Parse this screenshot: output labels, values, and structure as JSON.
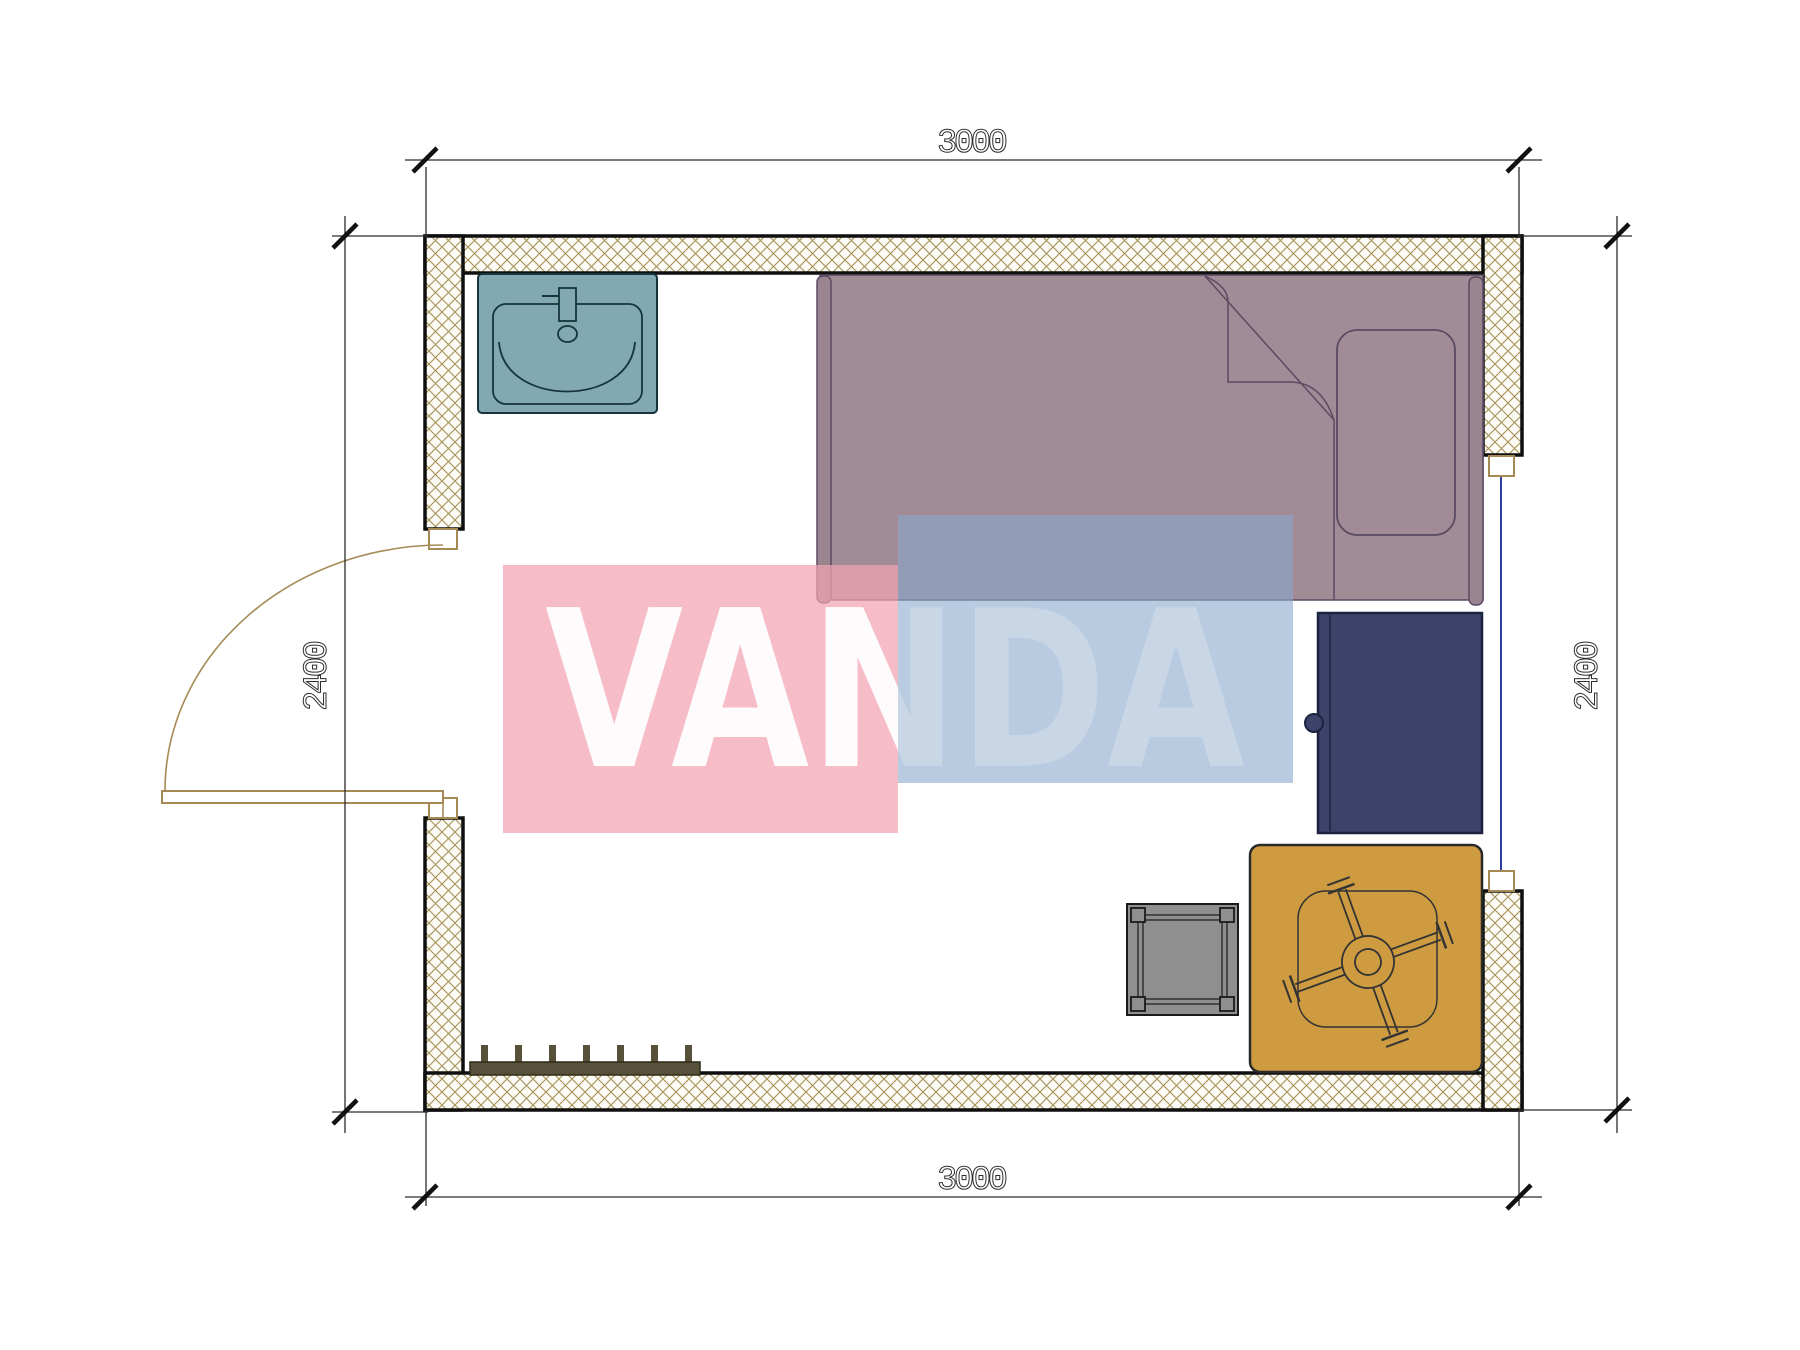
{
  "watermark": {
    "text": "VANDA",
    "pink_block": "#F2A4B3",
    "blue_block": "#8AA8CC",
    "text_color": "#FFFFFF"
  },
  "dimensions": {
    "top": "3000",
    "bottom": "3000",
    "left": "2400",
    "right": "2400"
  },
  "colors": {
    "wall_bg": "#FCFBF6",
    "hatch_line": "#A59055",
    "wall_outline": "#0F0F0F",
    "bed_fill": "#A18B97",
    "bed_bar_fill": "#9A8490",
    "bed_outline": "#5A4A62",
    "sink_fill": "#82A9B1",
    "sink_outline": "#16343C",
    "cabinet_fill": "#3C4268",
    "cabinet_outline": "#1C2340",
    "table_fill": "#CE9B41",
    "table_outline": "#2A2A2A",
    "table_detail": "#333333",
    "stool_fill": "#8F8F8F",
    "stool_outline": "#1A1A1A",
    "radiator_fill": "#57503A",
    "radiator_outline": "#2E2A18",
    "door_line": "#A58A55",
    "window_line": "#2C3E9E",
    "dim_line": "#2B2B2B",
    "tick_color": "#111111",
    "white": "#FFFFFF"
  },
  "furniture": {
    "sink": "sink",
    "bed": "single-bed",
    "wardrobe": "wardrobe",
    "stool": "stool",
    "table": "table-with-cross-base",
    "radiator": "radiator",
    "door": "door-swing",
    "window": "window"
  }
}
